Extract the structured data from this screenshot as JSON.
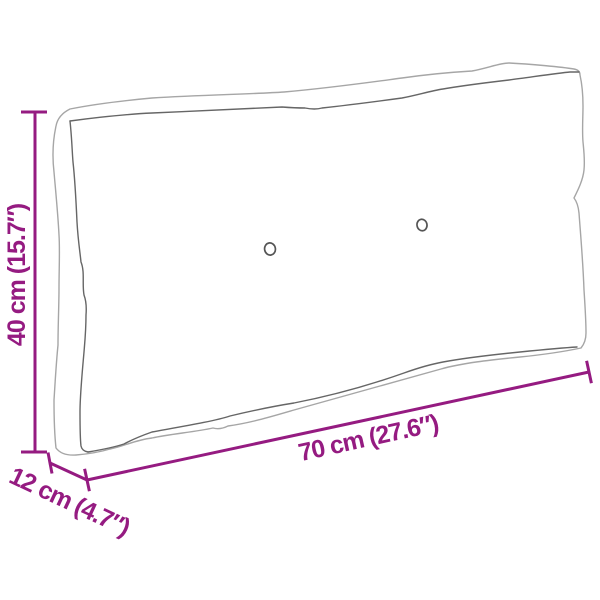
{
  "diagram": {
    "labels": {
      "height": "40 cm (15.7″)",
      "width": "70 cm (27.6″)",
      "depth": "12 cm (4.7″)"
    },
    "colors": {
      "dimension_accent": "#951b81",
      "outline_light": "#a6a6a6",
      "outline_dark": "#666666",
      "button_outline": "#555555"
    }
  }
}
